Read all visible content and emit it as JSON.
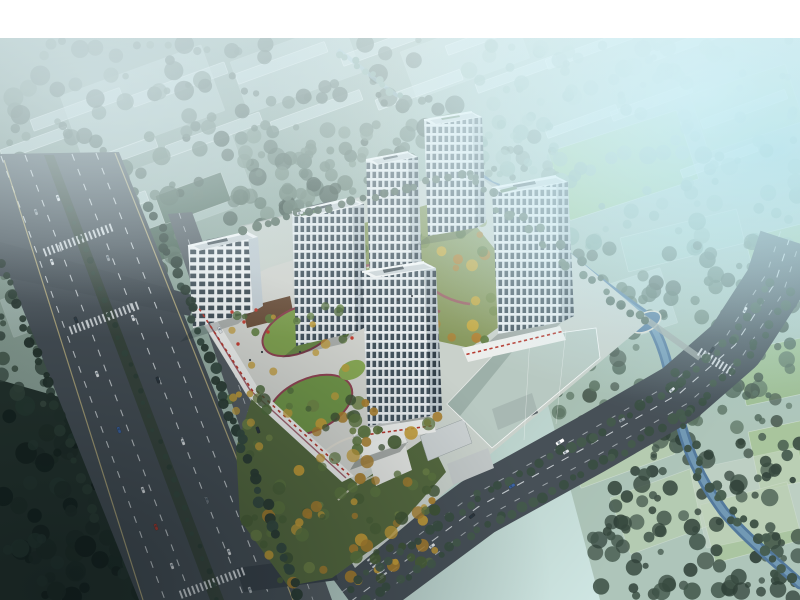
{
  "meta": {
    "description": "Aerial bird's-eye architectural rendering of a residential development: five white high-rise towers and an office block on a retail podium with roof gardens and a central landscaped courtyard, flanked by a multi-lane highway on the left, a tree-lined avenue and canal on the right, a corner park with a clubhouse, and hazy low-rise / greenhouse context blocks fading to bright cyan at the top right",
    "canvas": {
      "width": 800,
      "height": 600
    },
    "frame_top_height": 38
  },
  "palette": {
    "white": "#ffffff",
    "asphalt": "#475057",
    "asphaltDark": "#39424a",
    "sideRoad": "#545c62",
    "roadLight": "#b2b8b5",
    "laneWhite": "#e4e9ec",
    "laneYellow": "#cfc187",
    "median": "#39463e",
    "siteGround": "#c9d1cb",
    "plaza": "#d2d4cf",
    "plazaCourt": "#6b4f3a",
    "lawn": "#7f9a4f",
    "lawnDeep": "#64803f",
    "track": "#9c5a64",
    "maroon": "#8e4352",
    "pathLight": "#e2ded2",
    "facade": "#e9edef",
    "facadeShade": "#c1cbd1",
    "windowDark": "#3f4e58",
    "roofWhite": "#f2f4f4",
    "roofInner": "#ccd3d6",
    "roofDark": "#4d585e",
    "roofGreen": "#5d7a5c",
    "water": "#53799c",
    "waterHi": "#8db5c9",
    "ghost": "#b6c8c1",
    "fieldBright": "#8fbc74",
    "fieldSoft": "#a9c697",
    "fieldGhost": "#c9dcda",
    "grayBldg": "#ccd2d3",
    "darkRoof": "#586266",
    "red": "#b5382e"
  },
  "scene": {
    "buildings": {
      "towers": [
        "tower-west",
        "tower-north-slim",
        "tower-north-east",
        "tower-east-wide",
        "tower-south"
      ],
      "office": "office-block",
      "clubhouse": "park-clubhouse"
    },
    "fields": [
      {
        "x": 548,
        "y": 152,
        "w": 135,
        "h": 72,
        "rot": -18,
        "fill": "#8fbc74",
        "op": 0.9
      },
      {
        "x": 690,
        "y": 95,
        "w": 100,
        "h": 60,
        "rot": -18,
        "fill": "#a4c48e",
        "op": 0.7
      },
      {
        "x": 745,
        "y": 238,
        "w": 85,
        "h": 70,
        "rot": -14,
        "fill": "#9dbd8a",
        "op": 0.8
      },
      {
        "x": 735,
        "y": 352,
        "w": 75,
        "h": 55,
        "rot": -12,
        "fill": "#9dbd8a",
        "op": 0.8
      },
      {
        "x": 748,
        "y": 432,
        "w": 80,
        "h": 60,
        "rot": -12,
        "fill": "#a9c697",
        "op": 0.8
      },
      {
        "x": 700,
        "y": 505,
        "w": 90,
        "h": 60,
        "rot": -15,
        "fill": "#a9c697",
        "op": 0.7
      },
      {
        "x": 560,
        "y": 430,
        "w": 100,
        "h": 62,
        "rot": -20,
        "fill": "#b9cfae",
        "op": 0.7
      },
      {
        "x": 610,
        "y": 498,
        "w": 95,
        "h": 60,
        "rot": -20,
        "fill": "#b9cfae",
        "op": 0.6
      },
      {
        "x": 690,
        "y": 470,
        "w": 110,
        "h": 80,
        "rot": -12,
        "fill": "#ccd9cc",
        "op": 0.5
      },
      {
        "x": 620,
        "y": 238,
        "w": 120,
        "h": 35,
        "rot": -14,
        "fill": "#a8c9bc",
        "op": 0.7
      },
      {
        "x": 560,
        "y": 300,
        "w": 105,
        "h": 58,
        "rot": -18,
        "fill": "#c9dcda",
        "op": 0.5
      },
      {
        "x": 60,
        "y": 96,
        "w": 150,
        "h": 70,
        "rot": -20,
        "fill": "#c9dcda",
        "op": 0.45
      },
      {
        "x": 230,
        "y": 62,
        "w": 120,
        "h": 55,
        "rot": -20,
        "fill": "#c9dcda",
        "op": 0.45
      },
      {
        "x": 400,
        "y": 52,
        "w": 120,
        "h": 50,
        "rot": -20,
        "fill": "#c9dcda",
        "op": 0.4
      },
      {
        "x": 100,
        "y": 182,
        "w": 140,
        "h": 70,
        "rot": -20,
        "fill": "#c9dcda",
        "op": 0.4
      },
      {
        "x": 118,
        "y": 240,
        "w": 70,
        "h": 34,
        "rot": -20,
        "fill": "#415a4b",
        "op": 0.9
      },
      {
        "x": 155,
        "y": 196,
        "w": 70,
        "h": 30,
        "rot": -20,
        "fill": "#4a6454",
        "op": 0.85
      },
      {
        "x": 0,
        "y": 300,
        "w": 60,
        "h": 40,
        "rot": -20,
        "fill": "#c9dcda",
        "op": 0.35
      }
    ],
    "strips": [
      {
        "x": 30,
        "y": 120,
        "l": 95,
        "t": 12
      },
      {
        "x": 130,
        "y": 96,
        "l": 100,
        "t": 12
      },
      {
        "x": 235,
        "y": 74,
        "l": 95,
        "t": 11
      },
      {
        "x": 340,
        "y": 56,
        "l": 90,
        "t": 11
      },
      {
        "x": 445,
        "y": 46,
        "l": 80,
        "t": 10
      },
      {
        "x": 60,
        "y": 170,
        "l": 100,
        "t": 12
      },
      {
        "x": 165,
        "y": 146,
        "l": 100,
        "t": 12
      },
      {
        "x": 270,
        "y": 122,
        "l": 95,
        "t": 11
      },
      {
        "x": 375,
        "y": 100,
        "l": 90,
        "t": 11
      },
      {
        "x": 475,
        "y": 84,
        "l": 85,
        "t": 10
      },
      {
        "x": 70,
        "y": 218,
        "l": 80,
        "t": 11
      },
      {
        "x": 0,
        "y": 150,
        "l": 70,
        "t": 11
      },
      {
        "x": 545,
        "y": 60,
        "l": 90,
        "t": 10
      },
      {
        "x": 650,
        "y": 52,
        "l": 100,
        "t": 10
      },
      {
        "x": 700,
        "y": 120,
        "l": 90,
        "t": 10
      },
      {
        "x": 610,
        "y": 112,
        "l": 85,
        "t": 10
      },
      {
        "x": 545,
        "y": 130,
        "l": 75,
        "t": 9
      },
      {
        "x": 680,
        "y": 170,
        "l": 80,
        "t": 9
      }
    ],
    "forests": [
      {
        "layer": "gen-forest-under",
        "x": 0,
        "y": 40,
        "w": 460,
        "h": 260,
        "n": 220,
        "r0": 3,
        "r1": 10,
        "op": 0.9,
        "c": [
          "#42564b",
          "#4e6457",
          "#5a7062",
          "#37493f"
        ]
      },
      {
        "layer": "gen-forest-under",
        "x": 230,
        "y": 120,
        "w": 330,
        "h": 95,
        "n": 85,
        "r0": 3,
        "r1": 8,
        "op": 0.85,
        "c": [
          "#5d7365",
          "#6a8172",
          "#4e6457"
        ]
      },
      {
        "layer": "gen-forest-under",
        "x": 460,
        "y": 40,
        "w": 340,
        "h": 210,
        "n": 150,
        "r0": 3,
        "r1": 9,
        "op": 0.8,
        "c": [
          "#7da092",
          "#8cab9c",
          "#6f9486"
        ]
      },
      {
        "layer": "gen-forest-under",
        "x": 545,
        "y": 240,
        "w": 255,
        "h": 190,
        "n": 130,
        "r0": 3,
        "r1": 9,
        "op": 0.9,
        "c": [
          "#51685a",
          "#5d7464",
          "#48594e"
        ]
      },
      {
        "layer": "gen-forest-under",
        "x": 590,
        "y": 430,
        "w": 210,
        "h": 170,
        "n": 120,
        "r0": 3,
        "r1": 9,
        "op": 0.92,
        "c": [
          "#37493f",
          "#42564b",
          "#2e3f37"
        ]
      },
      {
        "layer": "gen-forest-under",
        "x": 0,
        "y": 400,
        "w": 300,
        "h": 200,
        "n": 160,
        "r0": 4,
        "r1": 11,
        "op": 0.95,
        "c": [
          "#16231f",
          "#1f2e28",
          "#273932"
        ]
      },
      {
        "layer": "gen-forest-under",
        "x": 0,
        "y": 250,
        "w": 120,
        "h": 160,
        "n": 60,
        "r0": 3,
        "r1": 8,
        "op": 0.9,
        "c": [
          "#33453c",
          "#3d5044"
        ]
      },
      {
        "layer": "gen-trees-mid",
        "x": 300,
        "y": 212,
        "w": 230,
        "h": 128,
        "n": 64,
        "r0": 2.5,
        "r1": 6,
        "op": 0.95,
        "c": [
          "#5f7a3e",
          "#74894a",
          "#c8a83e",
          "#b07f33",
          "#87975a"
        ]
      },
      {
        "layer": "gen-trees-over",
        "x": 246,
        "y": 398,
        "w": 196,
        "h": 186,
        "n": 115,
        "r0": 3,
        "r1": 7,
        "op": 0.95,
        "c": [
          "#3f5334",
          "#4a6038",
          "#5d7540",
          "#c29b38",
          "#a87e2e",
          "#6d8146"
        ]
      },
      {
        "layer": "gen-trees-over",
        "x": 228,
        "y": 300,
        "w": 118,
        "h": 128,
        "n": 30,
        "r0": 2.5,
        "r1": 5.5,
        "op": 0.95,
        "c": [
          "#4f6a3c",
          "#628043",
          "#c09b3a"
        ]
      }
    ],
    "tree_lines": [
      {
        "layer": "gen-trees-over",
        "pts": [
          [
            70,
            210
          ],
          [
            218,
            598
          ]
        ],
        "step": 14,
        "j": 2,
        "r0": 2,
        "r1": 3.5,
        "c": [
          "#2e4038",
          "#364a40"
        ]
      },
      {
        "layer": "gen-trees-over",
        "pts": [
          [
            152,
            208
          ],
          [
            298,
            592
          ]
        ],
        "step": 10,
        "j": 4,
        "r0": 3.5,
        "r1": 6,
        "c": [
          "#2b3c34",
          "#354a40"
        ]
      },
      {
        "layer": "gen-trees-over",
        "pts": [
          [
            2,
            262
          ],
          [
            96,
            520
          ]
        ],
        "step": 12,
        "j": 4,
        "r0": 3,
        "r1": 6,
        "c": [
          "#24332c",
          "#2c3e35"
        ]
      },
      {
        "layer": "gen-trees-over",
        "pts": [
          [
            348,
            588
          ],
          [
            480,
            496
          ],
          [
            592,
            436
          ],
          [
            680,
            384
          ],
          [
            734,
            338
          ],
          [
            772,
            282
          ]
        ],
        "step": 12,
        "j": 3,
        "r0": 3,
        "r1": 5.5,
        "c": [
          "#3a4e42",
          "#455a4c"
        ]
      },
      {
        "layer": "gen-trees-over",
        "pts": [
          [
            368,
            600
          ],
          [
            500,
            518
          ],
          [
            612,
            456
          ],
          [
            700,
            402
          ],
          [
            756,
            344
          ],
          [
            790,
            292
          ]
        ],
        "step": 12,
        "j": 3,
        "r0": 3,
        "r1": 5.5,
        "c": [
          "#3a4e42",
          "#455a4c"
        ]
      },
      {
        "layer": "gen-trees-over",
        "pts": [
          [
            244,
            228
          ],
          [
            470,
            172
          ]
        ],
        "step": 11,
        "j": 3,
        "r0": 3,
        "r1": 5,
        "c": [
          "#4a5f52",
          "#55695c"
        ]
      },
      {
        "layer": "gen-trees-over",
        "pts": [
          [
            464,
            176
          ],
          [
            648,
            324
          ]
        ],
        "step": 9,
        "j": 7,
        "r0": 3,
        "r1": 5,
        "c": [
          "#4e6356",
          "#5a7060"
        ]
      },
      {
        "layer": "gen-trees-over",
        "pts": [
          [
            672,
            366
          ],
          [
            700,
            470
          ],
          [
            740,
            524
          ],
          [
            796,
            580
          ]
        ],
        "step": 10,
        "j": 8,
        "r0": 3,
        "r1": 5.5,
        "c": [
          "#3c5044",
          "#465c4e"
        ]
      },
      {
        "layer": "gen-trees-over",
        "pts": [
          [
            340,
            52
          ],
          [
            398,
            96
          ]
        ],
        "step": 8,
        "j": 3,
        "r0": 2.5,
        "r1": 4,
        "c": [
          "#6f9486",
          "#7da092"
        ]
      }
    ],
    "awnings": [
      {
        "pts": [
          [
            200,
            310
          ],
          [
            252,
            390
          ]
        ],
        "step": 7,
        "c": "#b5382e"
      },
      {
        "pts": [
          [
            258,
            392
          ],
          [
            348,
            474
          ]
        ],
        "step": 7,
        "c": "#b5382e"
      },
      {
        "pts": [
          [
            468,
            354
          ],
          [
            560,
            332
          ]
        ],
        "step": 6,
        "c": "#b5382e"
      },
      {
        "pts": [
          [
            372,
            434
          ],
          [
            430,
            426
          ]
        ],
        "step": 6,
        "c": "#b5382e"
      }
    ],
    "dots": [
      {
        "x": 232,
        "y": 312,
        "r": 1.7,
        "c": "#c23f33"
      },
      {
        "x": 244,
        "y": 322,
        "r": 1.7,
        "c": "#c23f33"
      },
      {
        "x": 256,
        "y": 310,
        "r": 1.7,
        "c": "#c23f33"
      },
      {
        "x": 268,
        "y": 332,
        "r": 1.7,
        "c": "#c23f33"
      },
      {
        "x": 238,
        "y": 344,
        "r": 1.7,
        "c": "#c23f33"
      },
      {
        "x": 352,
        "y": 338,
        "r": 1.7,
        "c": "#c23f33"
      },
      {
        "x": 262,
        "y": 352,
        "r": 1.1,
        "c": "#3a4045"
      },
      {
        "x": 250,
        "y": 360,
        "r": 1.1,
        "c": "#3a4045"
      },
      {
        "x": 398,
        "y": 300,
        "r": 1.1,
        "c": "#3a4045"
      },
      {
        "x": 412,
        "y": 296,
        "r": 1.1,
        "c": "#3a4045"
      },
      {
        "x": 300,
        "y": 352,
        "r": 1.1,
        "c": "#3a4045"
      }
    ],
    "vehicles": [
      {
        "x": 52,
        "y": 262,
        "r": 69,
        "c": "#e3e7ea"
      },
      {
        "x": 76,
        "y": 320,
        "r": 69,
        "c": "#2c353c"
      },
      {
        "x": 97,
        "y": 374,
        "r": 69,
        "c": "#e3e7ea"
      },
      {
        "x": 119,
        "y": 430,
        "r": 69,
        "c": "#3d64a6"
      },
      {
        "x": 143,
        "y": 490,
        "r": 69,
        "c": "#e3e7ea"
      },
      {
        "x": 156,
        "y": 527,
        "r": 69,
        "c": "#b03a2e"
      },
      {
        "x": 172,
        "y": 566,
        "r": 69,
        "c": "#dde1e4"
      },
      {
        "x": 108,
        "y": 258,
        "r": 69,
        "c": "#9aa2a8"
      },
      {
        "x": 133,
        "y": 318,
        "r": 69,
        "c": "#e3e7ea"
      },
      {
        "x": 158,
        "y": 380,
        "r": 69,
        "c": "#2c353c"
      },
      {
        "x": 183,
        "y": 442,
        "r": 69,
        "c": "#e3e7ea"
      },
      {
        "x": 207,
        "y": 500,
        "r": 69,
        "c": "#6c757d"
      },
      {
        "x": 229,
        "y": 552,
        "r": 69,
        "c": "#e3e7ea"
      },
      {
        "x": 250,
        "y": 590,
        "r": 69,
        "c": "#aeb5ba"
      },
      {
        "x": 58,
        "y": 198,
        "r": 69,
        "c": "#e3e7ea"
      },
      {
        "x": 36,
        "y": 212,
        "r": 69,
        "c": "#9aa2a8"
      },
      {
        "x": 220,
        "y": 330,
        "r": 70,
        "c": "#e3e7ea"
      },
      {
        "x": 258,
        "y": 430,
        "r": 70,
        "c": "#2c353c"
      },
      {
        "x": 432,
        "y": 546,
        "r": -37,
        "c": "#e3e7ea"
      },
      {
        "x": 472,
        "y": 516,
        "r": -37,
        "c": "#2c353c"
      },
      {
        "x": 512,
        "y": 486,
        "r": -33,
        "c": "#3d64a6"
      },
      {
        "x": 566,
        "y": 452,
        "r": -30,
        "c": "#e3e7ea"
      },
      {
        "x": 622,
        "y": 420,
        "r": -30,
        "c": "#9aa2a8"
      },
      {
        "x": 672,
        "y": 390,
        "r": -42,
        "c": "#e3e7ea"
      },
      {
        "x": 560,
        "y": 442,
        "r": -32,
        "c": "#ffffff",
        "l": 9,
        "w2": 3.6
      },
      {
        "x": 712,
        "y": 350,
        "r": -55,
        "c": "#2c353c"
      },
      {
        "x": 745,
        "y": 310,
        "r": -62,
        "c": "#e3e7ea"
      },
      {
        "x": 300,
        "y": 213,
        "r": -13,
        "c": "#e3e7ea"
      }
    ],
    "crosswalks": [
      {
        "x": 78,
        "y": 240,
        "rot": 69.5,
        "n": 17,
        "sp": 4.4
      },
      {
        "x": 104,
        "y": 318,
        "rot": 69.5,
        "n": 17,
        "sp": 4.4
      },
      {
        "x": 212,
        "y": 583,
        "rot": 69.5,
        "n": 16,
        "sp": 4.4
      },
      {
        "x": 372,
        "y": 560,
        "rot": -37,
        "n": 10,
        "sp": 4.2
      },
      {
        "x": 716,
        "y": 362,
        "rot": -58,
        "n": 10,
        "sp": 4.2
      }
    ]
  }
}
